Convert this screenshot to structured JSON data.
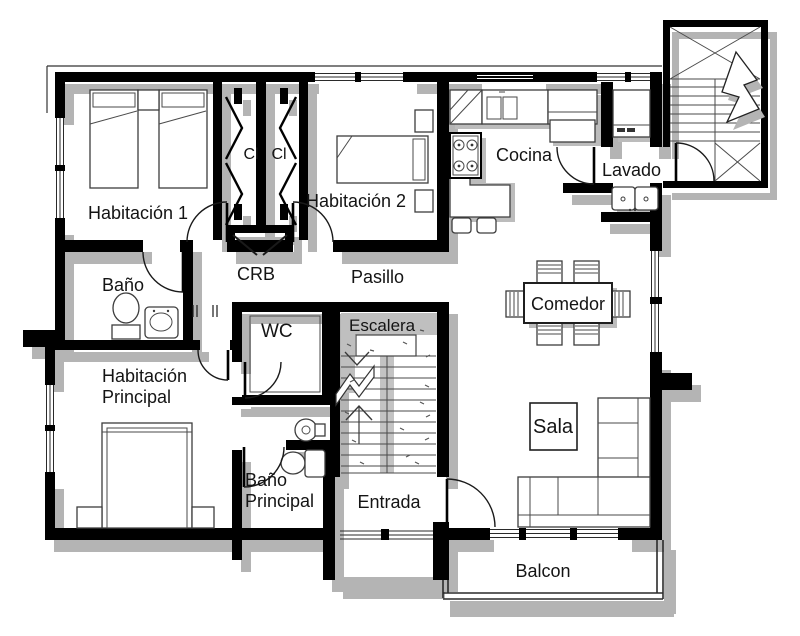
{
  "figure": {
    "type": "floor-plan",
    "labels": {
      "habitacion1": "Habitación 1",
      "closet_left": "Cl",
      "closet_right": "Cl",
      "habitacion2": "Habitación 2",
      "cocina": "Cocina",
      "lavado": "Lavado",
      "bano": "Baño",
      "crb": "CRB",
      "pasillo": "Pasillo",
      "comedor": "Comedor",
      "wc": "WC",
      "escalera": "Escalera",
      "habitacion_principal_line1": "Habitación",
      "habitacion_principal_line2": "Principal",
      "bano_principal_line1": "Baño",
      "bano_principal_line2": "Principal",
      "entrada": "Entrada",
      "sala": "Sala",
      "balcon": "Balcon"
    },
    "colors": {
      "wall": "#000000",
      "shadow": "#b4b4b4",
      "background": "#ffffff",
      "furniture_line": "#3d3d3d",
      "stair_fill": "#bfbfbf",
      "text": "#141414"
    }
  }
}
